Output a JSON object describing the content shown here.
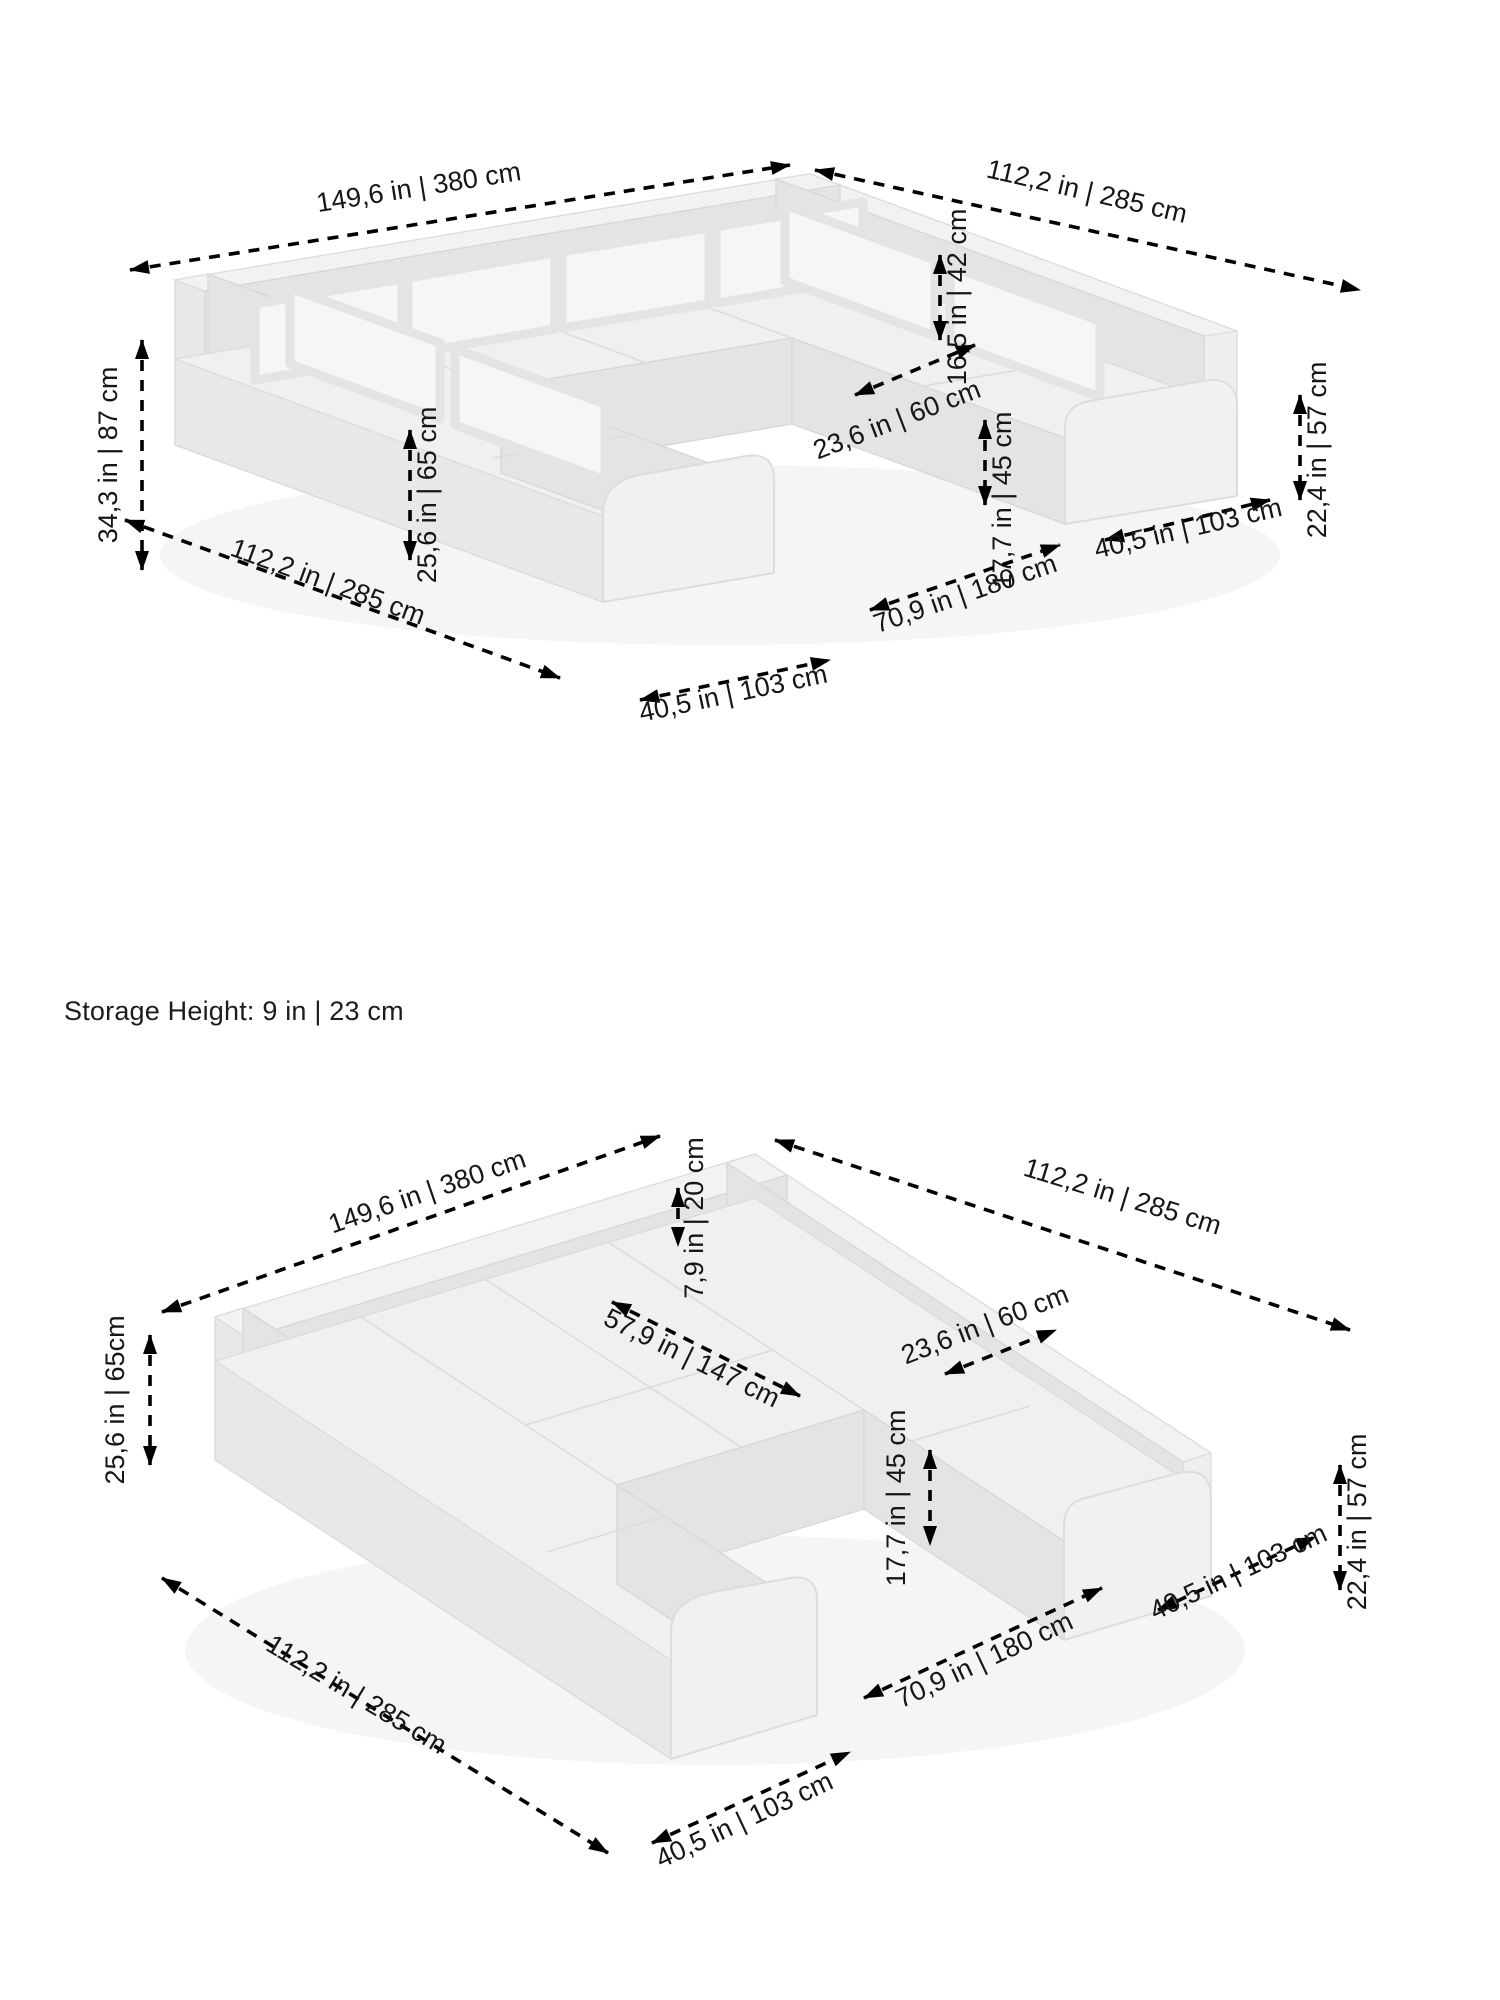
{
  "storage_note": "Storage Height: 9 in | 23 cm",
  "top_view": {
    "dims": {
      "total_width": "149,6 in | 380 cm",
      "right_side_depth": "112,2 in | 285 cm",
      "total_height": "34,3 in | 87 cm",
      "back_cushion_height": "25,6 in | 65 cm",
      "backrest_above_seat": "16,5 in | 42 cm",
      "corner_seat_width": "23,6 in | 60 cm",
      "seat_height": "17,7 in | 45 cm",
      "armrest_height": "22,4 in | 57 cm",
      "left_side_depth": "112,2 in | 285 cm",
      "front_module_width": "40,5 in | 103 cm",
      "inner_width": "70,9 in | 180 cm",
      "right_module_width": "40,5 in | 103 cm"
    }
  },
  "bottom_view": {
    "dims": {
      "total_width": "149,6 in | 380 cm",
      "right_side_depth": "112,2 in | 285 cm",
      "backrest_height": "7,9 in | 20 cm",
      "bed_length": "57,9 in | 147 cm",
      "corner_seat_width": "23,6 in | 60 cm",
      "seat_height": "17,7 in | 45 cm",
      "armrest_height": "22,4 in | 57 cm",
      "side_height": "25,6 in | 65cm",
      "left_side_depth": "112,2 in | 285 cm",
      "front_module_width": "40,5 in | 103 cm",
      "inner_width": "70,9 in | 180 cm",
      "right_module_width": "40,5 in | 103 cm"
    }
  }
}
